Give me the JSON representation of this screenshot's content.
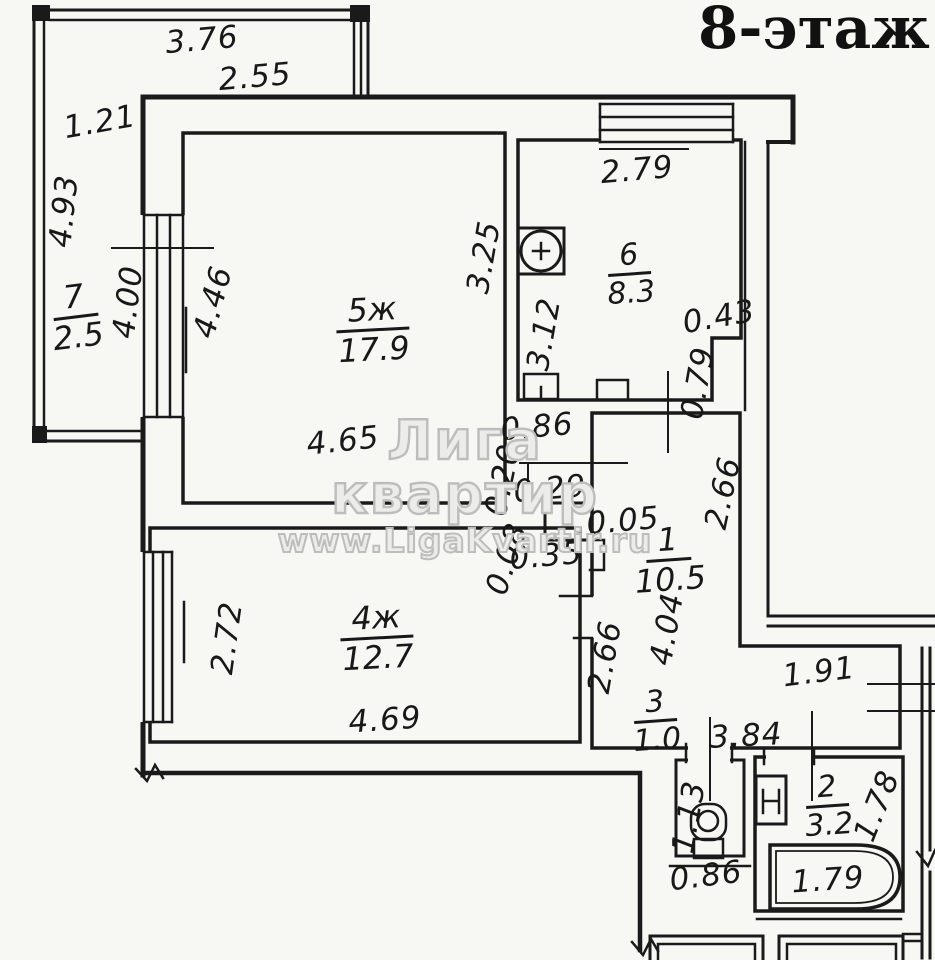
{
  "title": {
    "floor_label": "8-этаж",
    "clipped_text": "К"
  },
  "watermark": {
    "line1": "Лига квартир",
    "line2": "www.LigaKvartir.ru"
  },
  "rooms": [
    {
      "number": "1",
      "area": "10.5",
      "type": "hallway"
    },
    {
      "number": "2",
      "area": "3.2",
      "type": "bathroom"
    },
    {
      "number": "3",
      "area": "1.0",
      "type": "wc"
    },
    {
      "number": "4ж",
      "area": "12.7",
      "type": "living"
    },
    {
      "number": "5ж",
      "area": "17.9",
      "type": "living"
    },
    {
      "number": "6",
      "area": "8.3",
      "type": "kitchen"
    },
    {
      "number": "7",
      "area": "2.5",
      "type": "balcony"
    }
  ],
  "dimensions": {
    "balcony_width_top": "3.76",
    "balcony_width_inner": "2.55",
    "balcony_left_width": "1.21",
    "balcony_left_height": "4.93",
    "balcony_wall": "4.00",
    "room5_window_wall": "4.46",
    "room5_depth": "3.25",
    "room5_width": "4.65",
    "kitchen_width": "2.79",
    "kitchen_depth": "3.12",
    "kitchen_notch_width": "0.43",
    "kitchen_notch_height": "0.79",
    "jog_a": "0.86",
    "jog_b": "0.20",
    "jog_c": "0.29",
    "jog_d": "0.05",
    "jog_e": "0.08",
    "jog_f": "0.35",
    "hall_upper_height": "2.66",
    "hall_lower_height": "4.04",
    "room4_door_wall": "2.66",
    "vestibule_width": "1.91",
    "room4_window_wall": "2.72",
    "room4_width": "4.69",
    "corridor_span": "3.84",
    "wc_depth": "1.13",
    "wc_width": "0.86",
    "bath_depth": "1.78",
    "bathtub_length": "1.79"
  }
}
